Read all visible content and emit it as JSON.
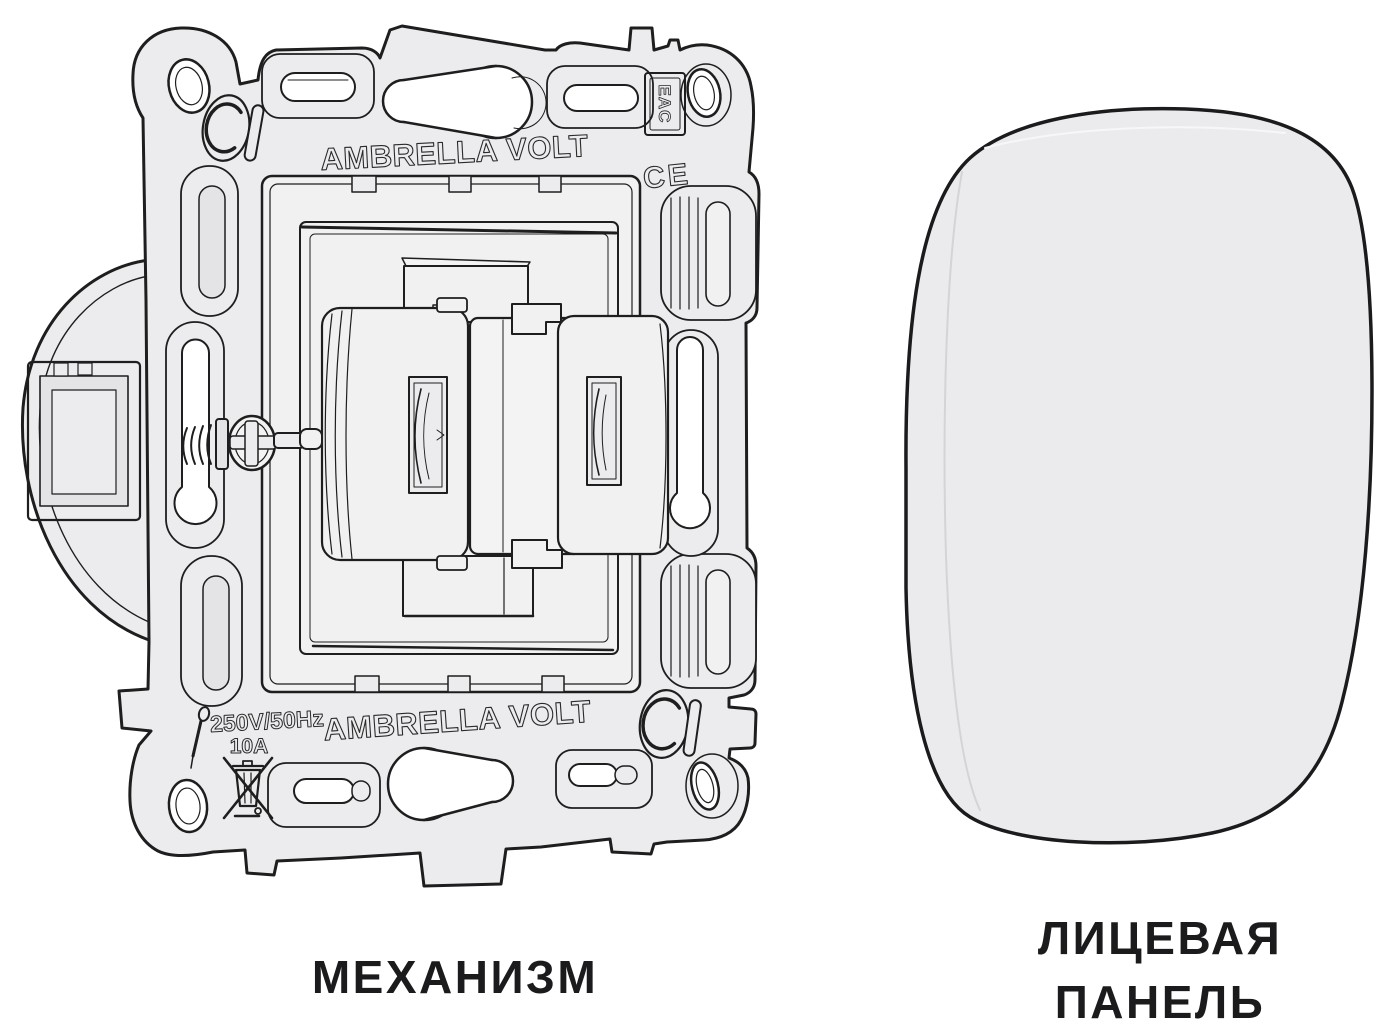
{
  "captions": {
    "mechanism": "МЕХАНИЗМ",
    "face_panel_line1": "ЛИЦЕВАЯ",
    "face_panel_line2": "ПАНЕЛЬ"
  },
  "mechanism": {
    "brand_text_top": "AMBRELLA VOLT",
    "brand_text_bottom": "AMBRELLA VOLT",
    "voltage_rating": "250V/50Hz",
    "current_rating": "10A",
    "eac_mark": "EAC",
    "ce_mark": "CE",
    "icons": [
      "c-monogram-icon",
      "screwdriver-icon",
      "weee-crossed-bin-icon",
      "phillips-screw-icon"
    ]
  },
  "colors": {
    "background": "#ffffff",
    "line": "#1e1e1e",
    "plate_fill": "#ececee",
    "panel_fill": "#ebebed",
    "caption_text": "#1b1b1d"
  }
}
